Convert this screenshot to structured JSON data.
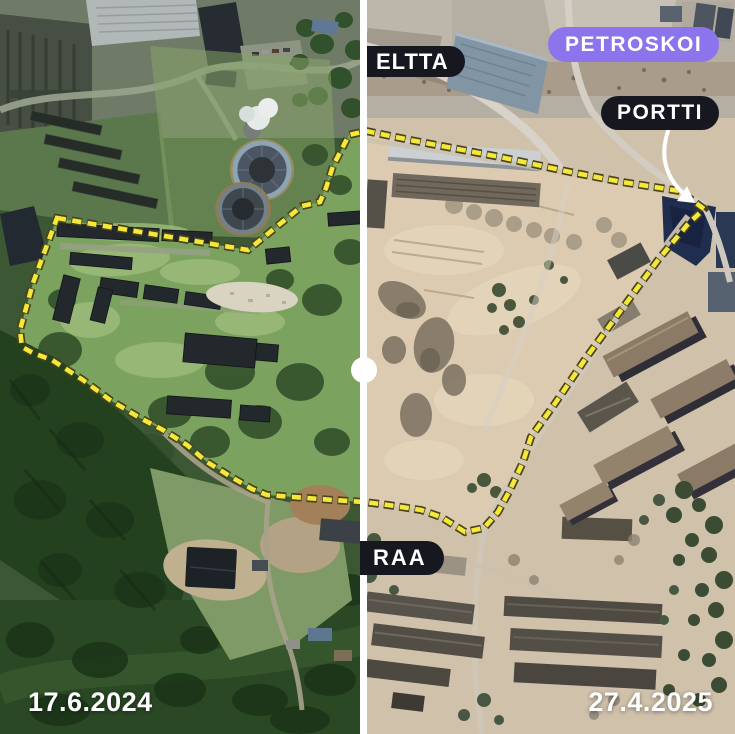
{
  "comparison": {
    "before_date": "17.6.2024",
    "after_date": "27.4.2025"
  },
  "labels": {
    "district_top": "ELTTA",
    "city": "PETROSKOI",
    "gate": "PORTTI",
    "district_bottom": "RAA"
  },
  "colors": {
    "city_badge": "#8b74ec",
    "dark_badge": "#17171f",
    "boundary_yellow": "#f4e93a",
    "boundary_outline": "#4a431c",
    "divider": "#ffffff",
    "arrow": "#ffffff"
  },
  "overlay": {
    "boundary_path": "M 57 218 L 248 250 L 302 206 L 320 202 L 326 188 L 333 166 L 349 135 L 366 131 L 410 140 L 500 157 L 570 172 L 622 182 L 680 191 L 704 209 L 688 224 L 658 260 L 641 283 L 616 317 L 586 358 L 556 402 L 531 437 L 523 462 L 510 490 L 498 512 L 484 528 L 465 532 L 441 517 L 421 510 L 388 505 L 364 502 L 333 500 L 267 495 L 252 489 L 233 478 L 207 462 L 187 445 L 163 430 L 140 418 L 110 400 L 83 380 L 52 360 L 33 353 L 22 347 L 20 330 L 33 283 Z",
    "arrow_path": "M 668 131 C 661 152 662 175 686 196",
    "arrow_head_points": "695,203 677,201 687,186"
  }
}
